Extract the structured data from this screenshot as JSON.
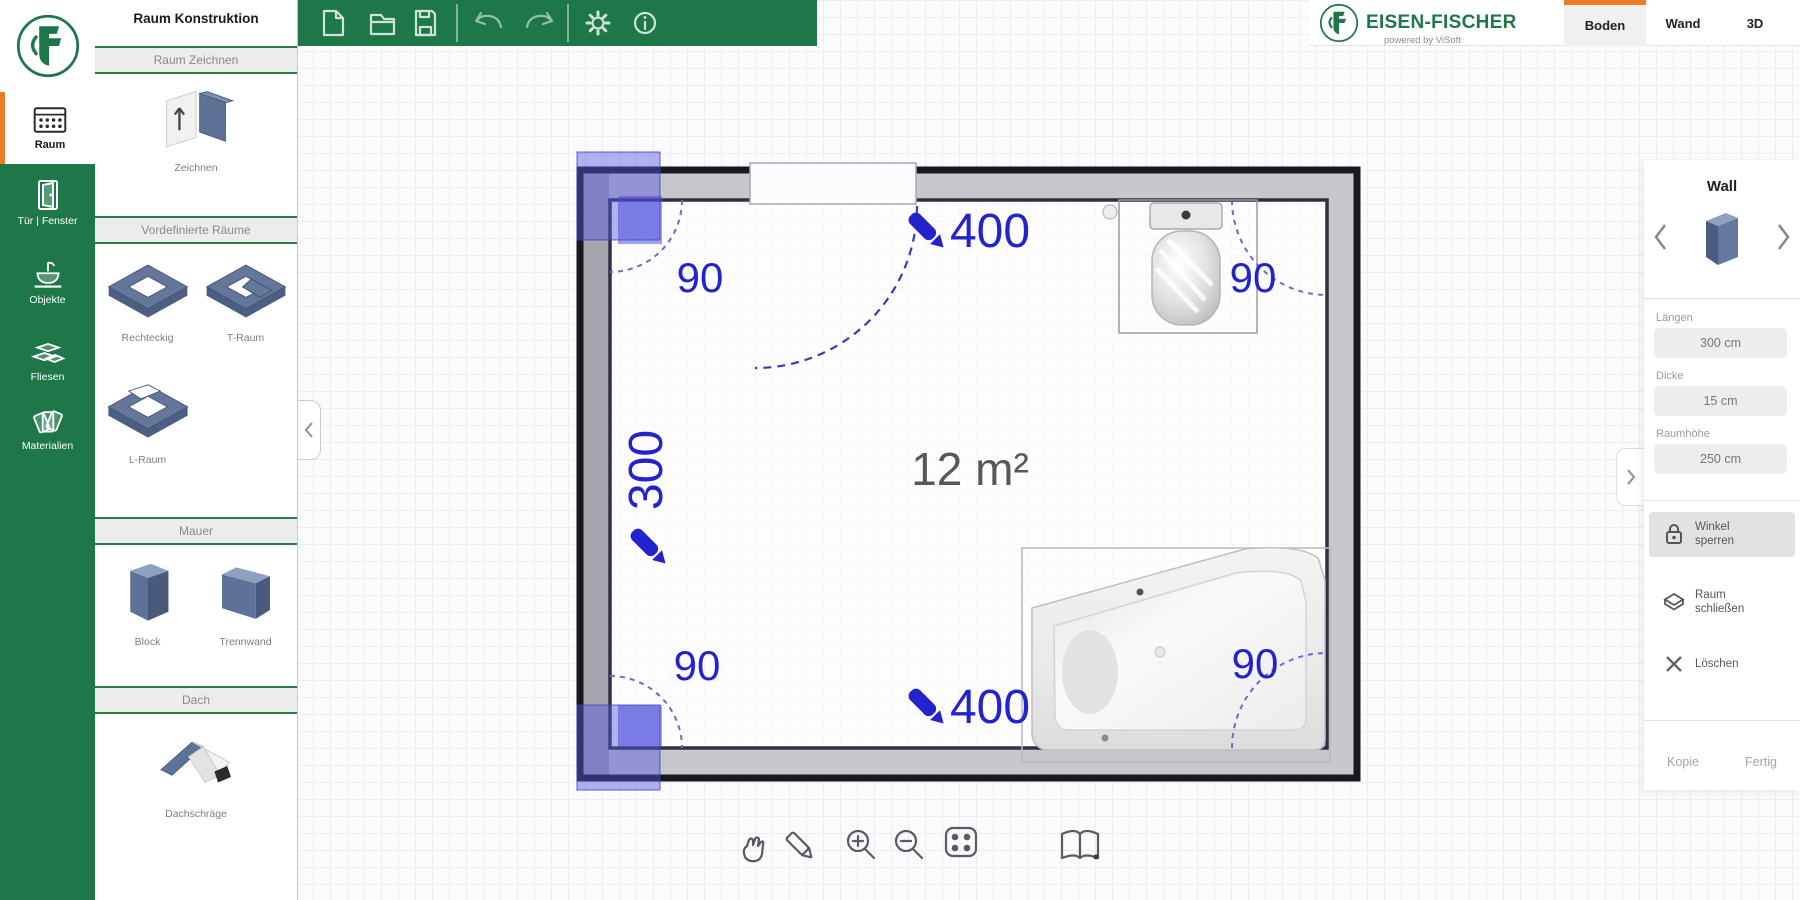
{
  "header": {
    "panel_title": "Raum Konstruktion",
    "brand": "EISEN-FISCHER",
    "brand_tagline": "powered by ViSoft",
    "tabs": [
      {
        "label": "Boden",
        "active": true
      },
      {
        "label": "Wand",
        "active": false
      },
      {
        "label": "3D",
        "active": false
      }
    ]
  },
  "toolbar": {
    "icons": [
      "new-file",
      "open-folder",
      "save-file",
      "undo",
      "redo",
      "settings-gear",
      "info"
    ]
  },
  "sidebar": {
    "items": [
      {
        "label": "Raum",
        "icon": "tiles-icon",
        "active": true
      },
      {
        "label": "Tür | Fenster",
        "icon": "door-icon",
        "active": false
      },
      {
        "label": "Objekte",
        "icon": "washbasin-icon",
        "active": false
      },
      {
        "label": "Fliesen",
        "icon": "tiles-stack-icon",
        "active": false
      },
      {
        "label": "Materialien",
        "icon": "swatches-icon",
        "active": false
      }
    ]
  },
  "panel": {
    "sections": [
      {
        "header": "Raum Zeichnen"
      },
      {
        "header": "Vordefinierte Räume"
      },
      {
        "header": "Mauer"
      },
      {
        "header": "Dach"
      }
    ],
    "items": {
      "zeichnen": "Zeichnen",
      "rechteckig": "Rechteckig",
      "t_raum": "T-Raum",
      "l_raum": "L-Raum",
      "block": "Block",
      "trennwand": "Trennwand",
      "dachschraege": "Dachschräge"
    }
  },
  "plan": {
    "area": "12 m²",
    "dim_top": "400",
    "dim_left": "300",
    "dim_bottom": "400",
    "angle_tl": "90",
    "angle_tr": "90",
    "angle_bl": "90",
    "angle_br": "90",
    "fixtures": [
      "toilet",
      "bathtub"
    ],
    "door": "door-swing-top-wall"
  },
  "bottom_toolbar": {
    "icons": [
      "pan-hand",
      "measure-pencil",
      "zoom-in",
      "zoom-out",
      "fit-view",
      "catalog-book"
    ]
  },
  "properties": {
    "title": "Wall",
    "fields": [
      {
        "label": "Längen",
        "value": "300 cm"
      },
      {
        "label": "Dicke",
        "value": "15 cm"
      },
      {
        "label": "Raumhöhe",
        "value": "250 cm"
      }
    ],
    "buttons": [
      {
        "line1": "Winkel",
        "line2": "sperren",
        "icon": "lock-icon",
        "active": true
      },
      {
        "line1": "Raum",
        "line2": "schließen",
        "icon": "room-icon",
        "active": false
      },
      {
        "line1": "Löschen",
        "line2": "",
        "icon": "x-icon",
        "active": false
      }
    ],
    "footer": {
      "copy": "Kopie",
      "done": "Fertig"
    }
  },
  "colors": {
    "green": "#1d7748",
    "orange": "#ee7a23",
    "blue": "#2323ce",
    "wall_gray": "#c7c7cc"
  }
}
